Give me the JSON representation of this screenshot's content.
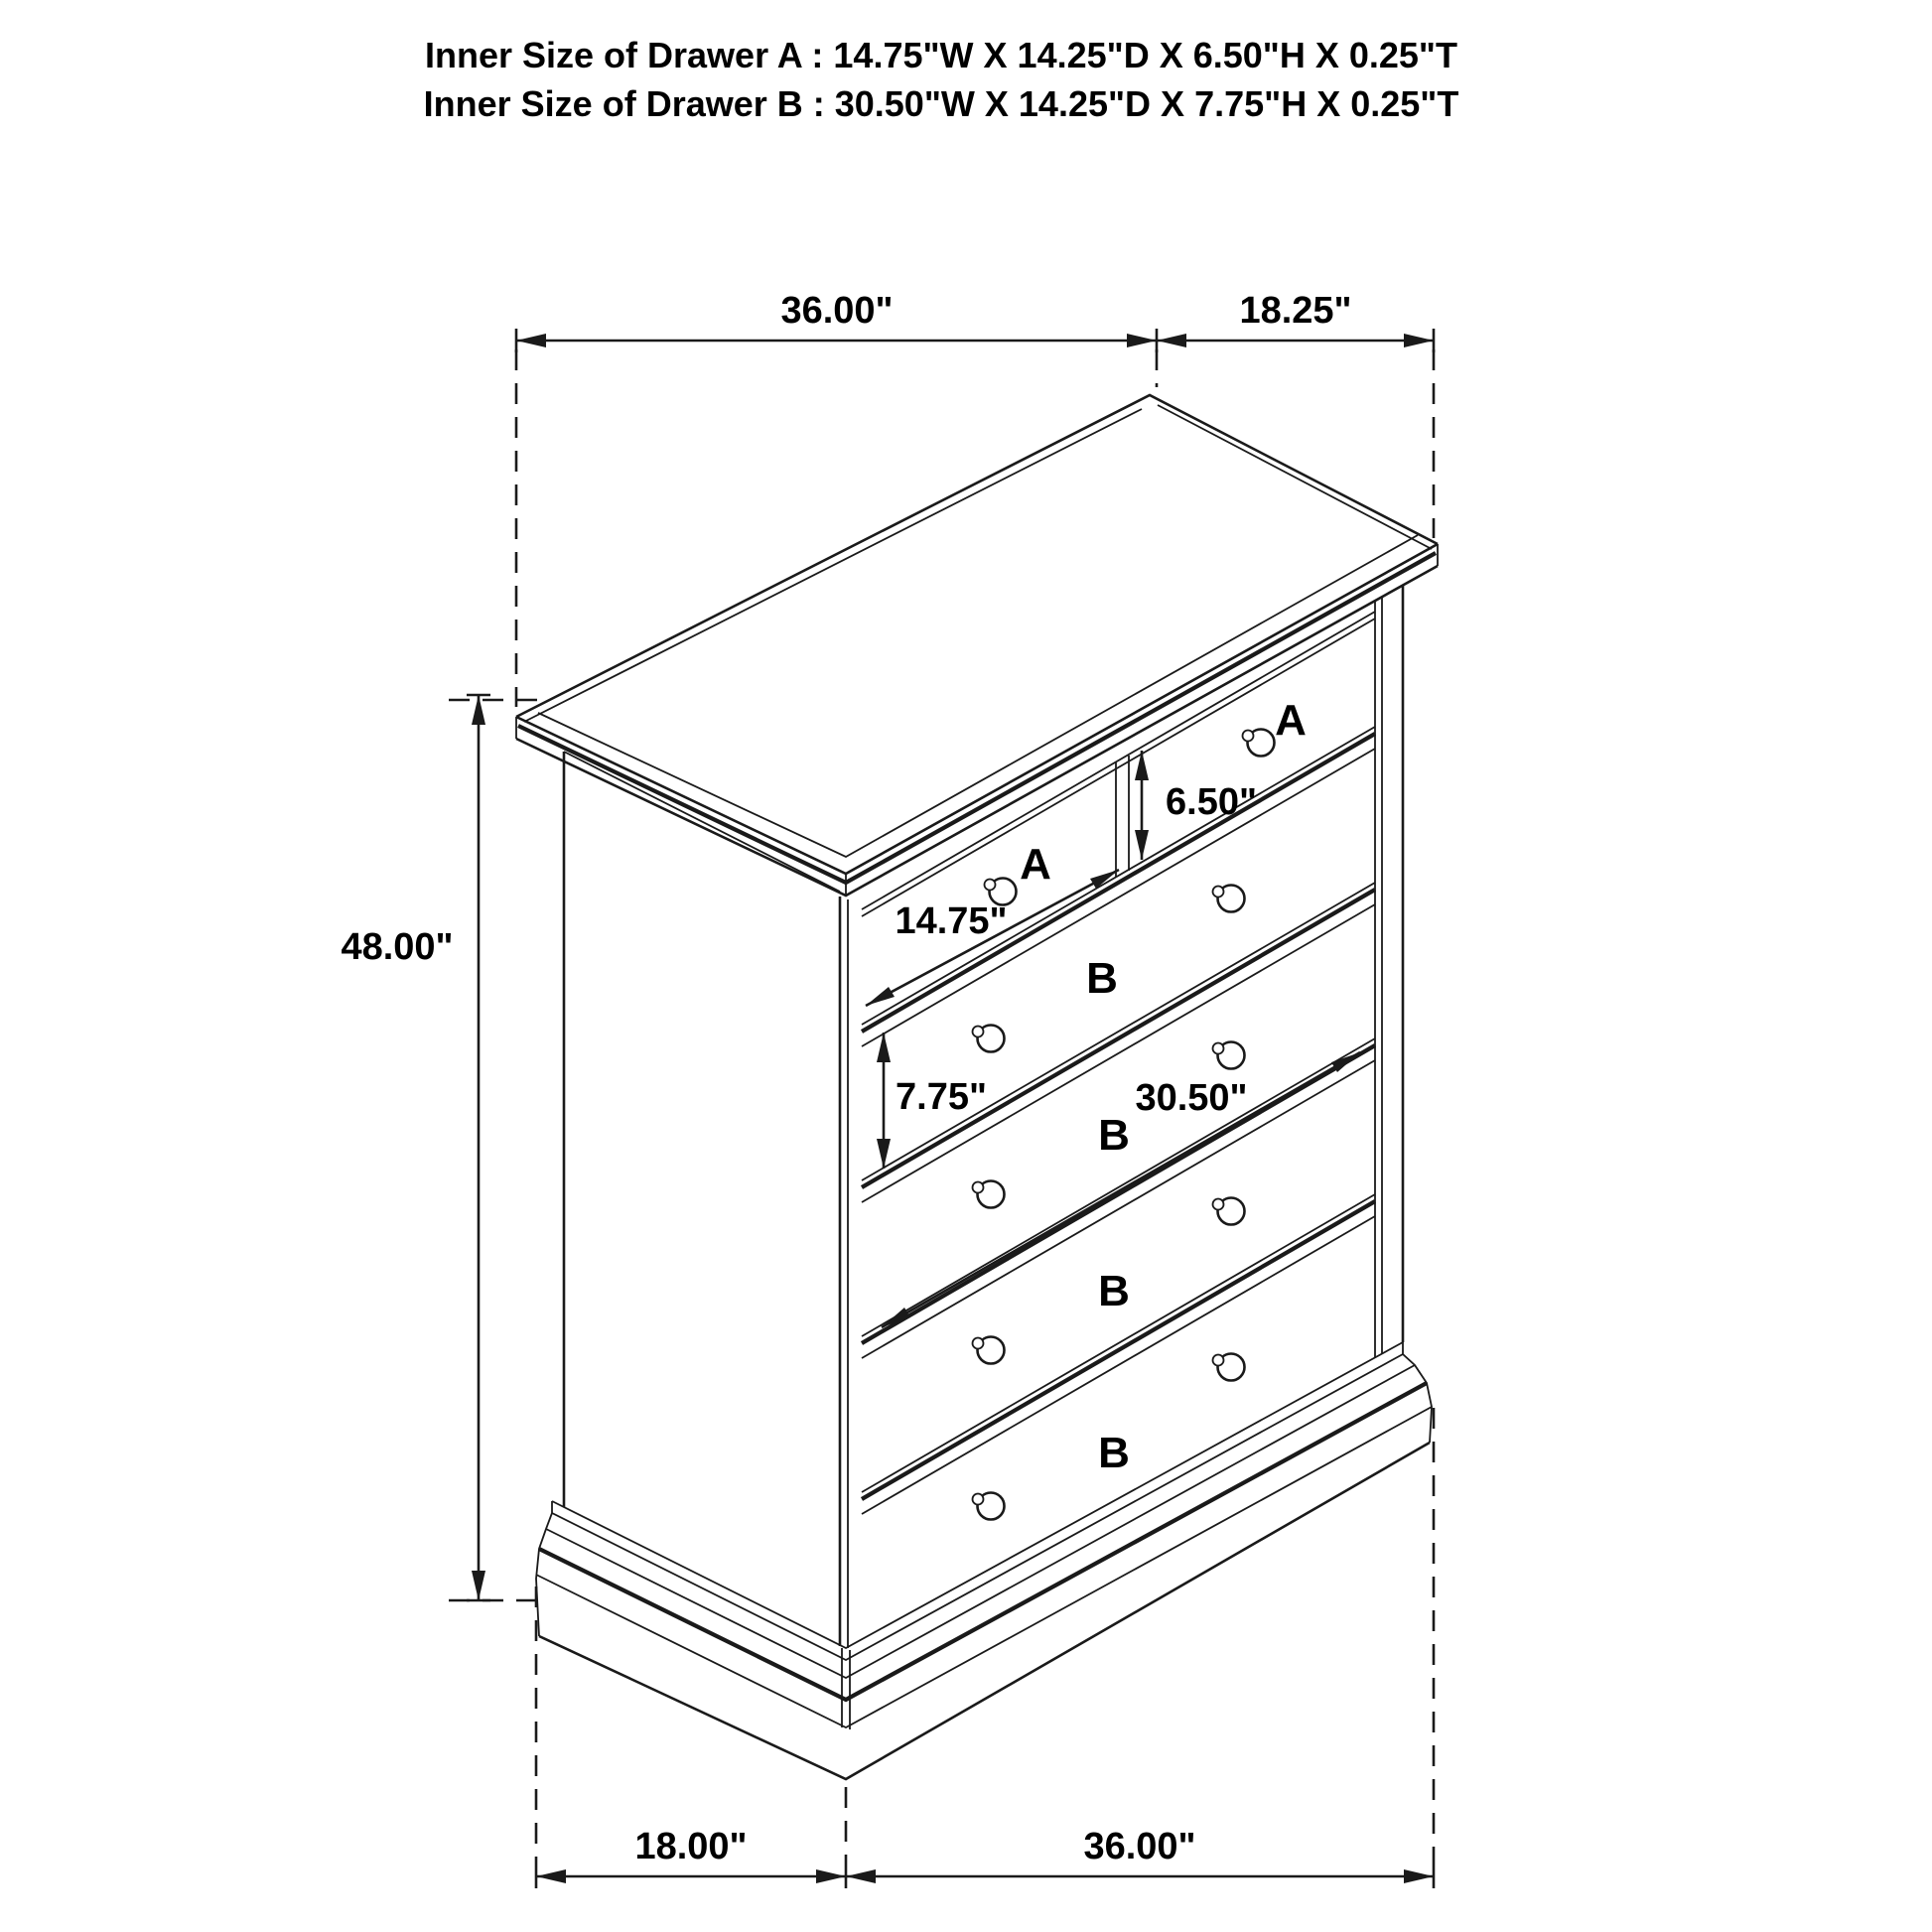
{
  "title": {
    "line1": "Inner Size of Drawer A : 14.75\"W X 14.25\"D X 6.50\"H X 0.25\"T",
    "line2": "Inner Size of Drawer B : 30.50\"W X 14.25\"D X 7.75\"H X 0.25\"T"
  },
  "dimensions": {
    "top_width": "36.00\"",
    "top_depth": "18.25\"",
    "height": "48.00\"",
    "drawer_a_height": "6.50\"",
    "drawer_a_width": "14.75\"",
    "drawer_b_height": "7.75\"",
    "drawer_b_width": "30.50\"",
    "bottom_depth": "18.00\"",
    "bottom_width": "36.00\""
  },
  "labels": {
    "drawer_a": "A",
    "drawer_b": "B"
  },
  "colors": {
    "line": "#1a1a1a",
    "label": "#ed1c24",
    "background": "#ffffff"
  }
}
